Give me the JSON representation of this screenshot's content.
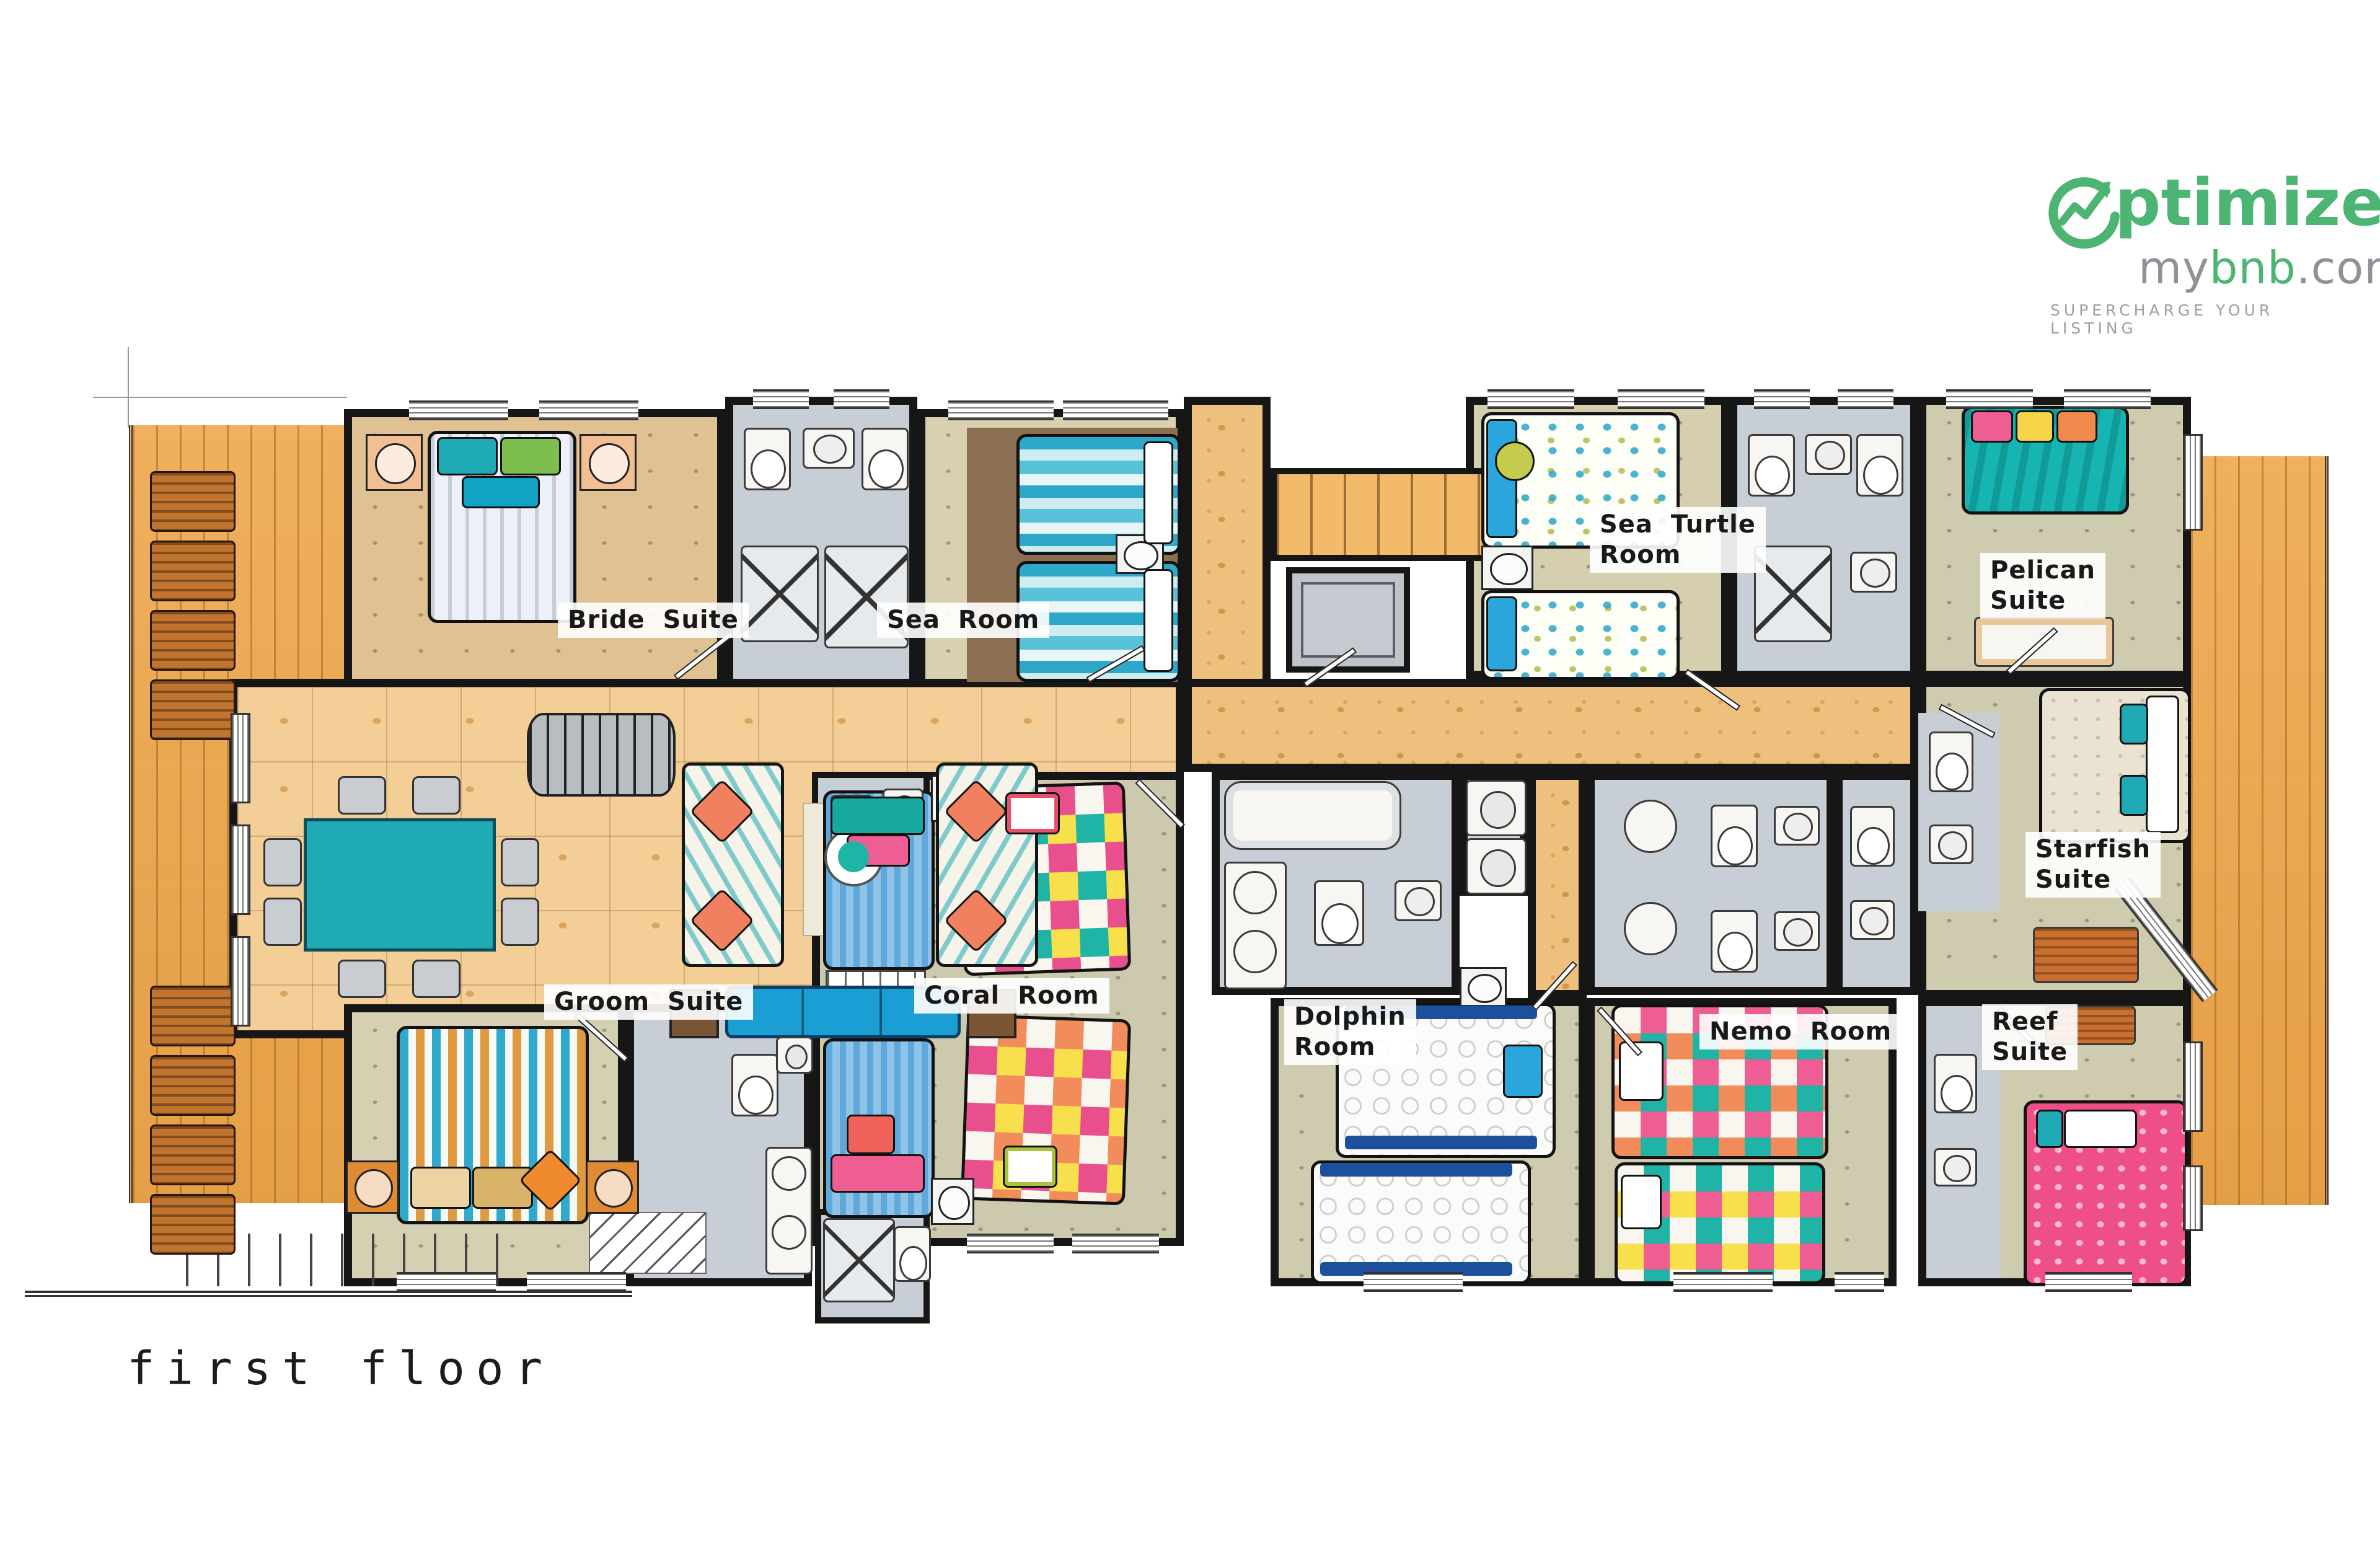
{
  "title": {
    "text": "first floor"
  },
  "logo": {
    "brand_text": "ptimize",
    "domain_my": "my",
    "domain_bnb": "bnb",
    "domain_com": ".com",
    "tagline": "SUPERCHARGE YOUR LISTING",
    "green": "#4CB573",
    "gray": "#8E9296"
  },
  "rooms": [
    {
      "id": "bride-suite",
      "line1": "Bride Suite",
      "line2": ""
    },
    {
      "id": "sea-room",
      "line1": "Sea Room",
      "line2": ""
    },
    {
      "id": "sea-turtle-room",
      "line1": "Sea Turtle",
      "line2": "Room"
    },
    {
      "id": "pelican-suite",
      "line1": "Pelican",
      "line2": "Suite"
    },
    {
      "id": "starfish-suite",
      "line1": "Starfish",
      "line2": "Suite"
    },
    {
      "id": "groom-suite",
      "line1": "Groom Suite",
      "line2": ""
    },
    {
      "id": "coral-room",
      "line1": "Coral Room",
      "line2": ""
    },
    {
      "id": "dolphin-room",
      "line1": "Dolphin",
      "line2": "Room"
    },
    {
      "id": "nemo-room",
      "line1": "Nemo Room",
      "line2": ""
    },
    {
      "id": "reef-suite",
      "line1": "Reef",
      "line2": "Suite"
    }
  ],
  "colors": {
    "wall": "#161616",
    "deck_wood": "#EFA94F",
    "great_room_tile": "#F3CE96",
    "corridor": "#EEC07E",
    "bedroom_khaki": "#CFCBAF",
    "bath_tile": "#C8CED5",
    "teal_accent": "#1FAAB5",
    "pink_accent": "#EF4F88",
    "logo_green": "#4CB573",
    "logo_gray": "#8E9296"
  }
}
